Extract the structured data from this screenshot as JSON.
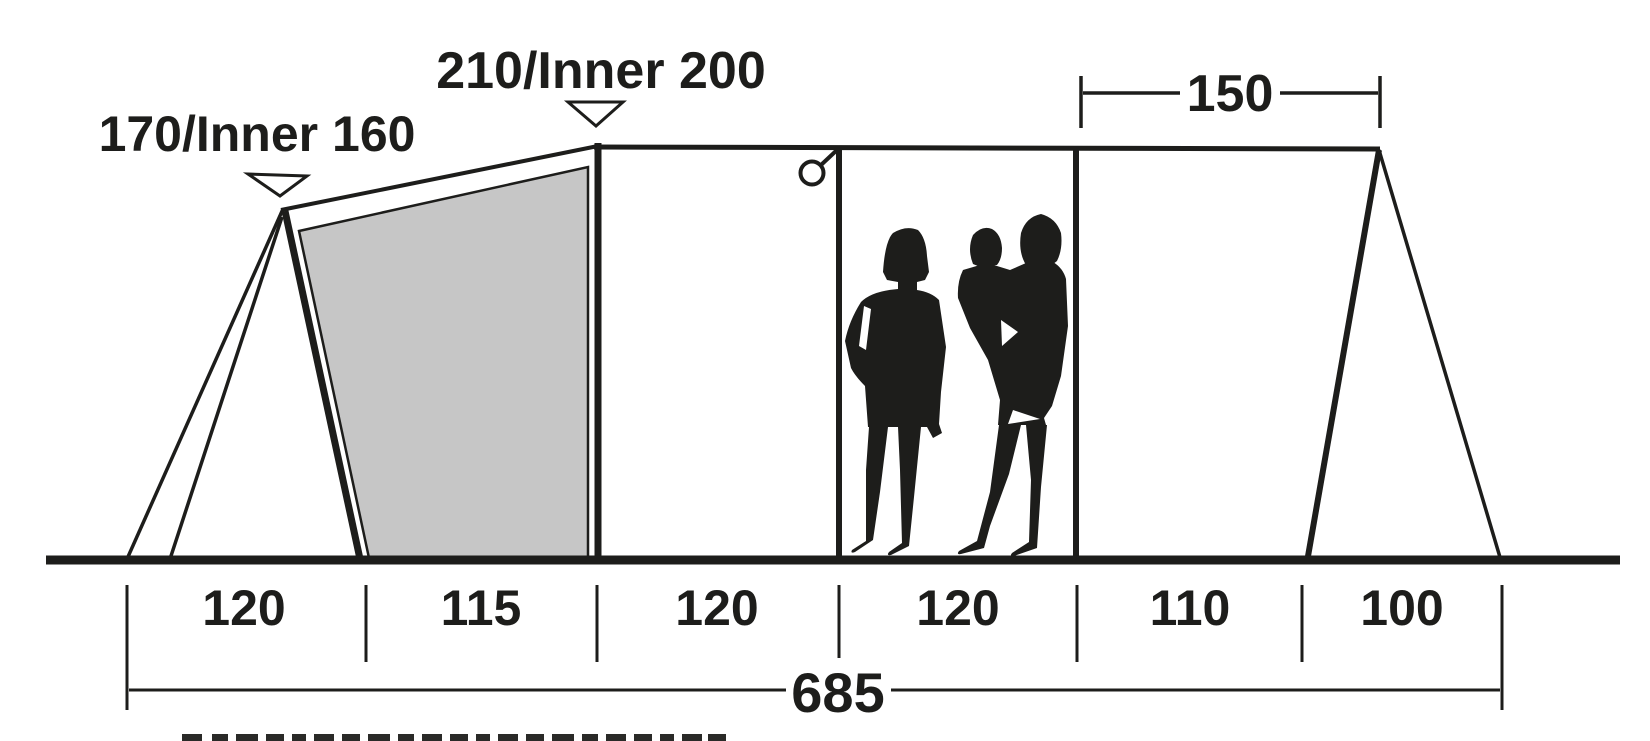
{
  "diagram": {
    "height_label_front": "170/Inner 160",
    "height_label_main": "210/Inner 200",
    "top_width": "150",
    "segments": [
      "120",
      "115",
      "120",
      "120",
      "110",
      "100"
    ],
    "total_width": "685",
    "colors": {
      "ink": "#1d1d1b",
      "panel_gray": "#c6c6c6",
      "background": "#ffffff"
    }
  }
}
